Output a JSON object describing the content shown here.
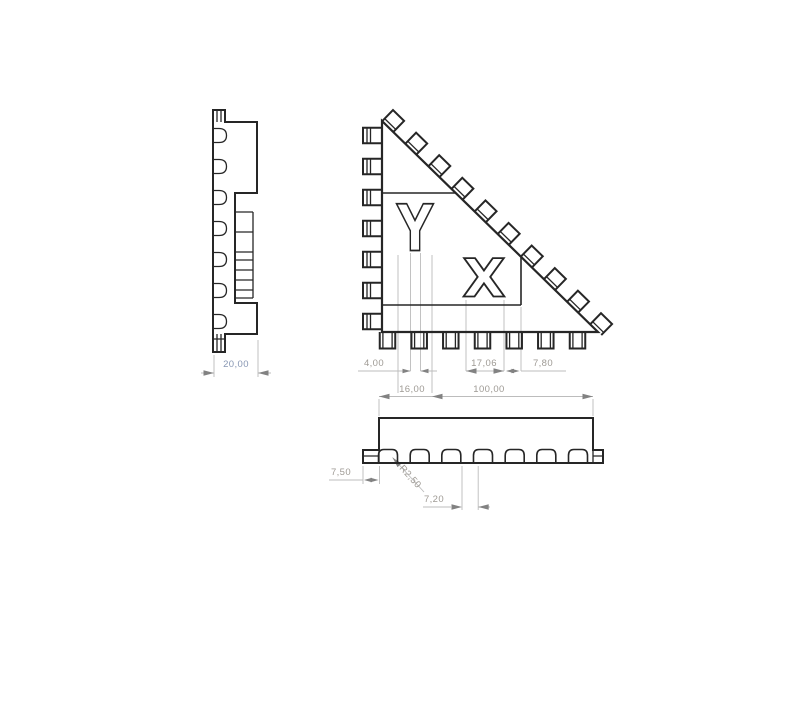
{
  "drawing": {
    "views": {
      "side": {
        "name": "side profile view",
        "dims": {
          "thickness": "20,00"
        }
      },
      "front": {
        "name": "triangular front view",
        "cutouts": {
          "letter_y": "Y",
          "letter_x": "X"
        },
        "dims": {
          "y_stem_width": "4,00",
          "x_width": "17,06",
          "x_to_pocket": "7,80",
          "y_width": "16,00",
          "overall_width": "100,00"
        }
      },
      "bottom": {
        "name": "bottom view",
        "dims": {
          "edge_offset": "7,50",
          "tooth_radius": "R2,50",
          "tooth_gap": "7,20"
        }
      }
    },
    "colors": {
      "background": "#ffffff",
      "geometry_line": "#262626",
      "dimension_line": "#bcbcbc",
      "dimension_text": "#9e9a94",
      "side_dimension_text": "#8796b3",
      "arrow": "#828282"
    }
  }
}
